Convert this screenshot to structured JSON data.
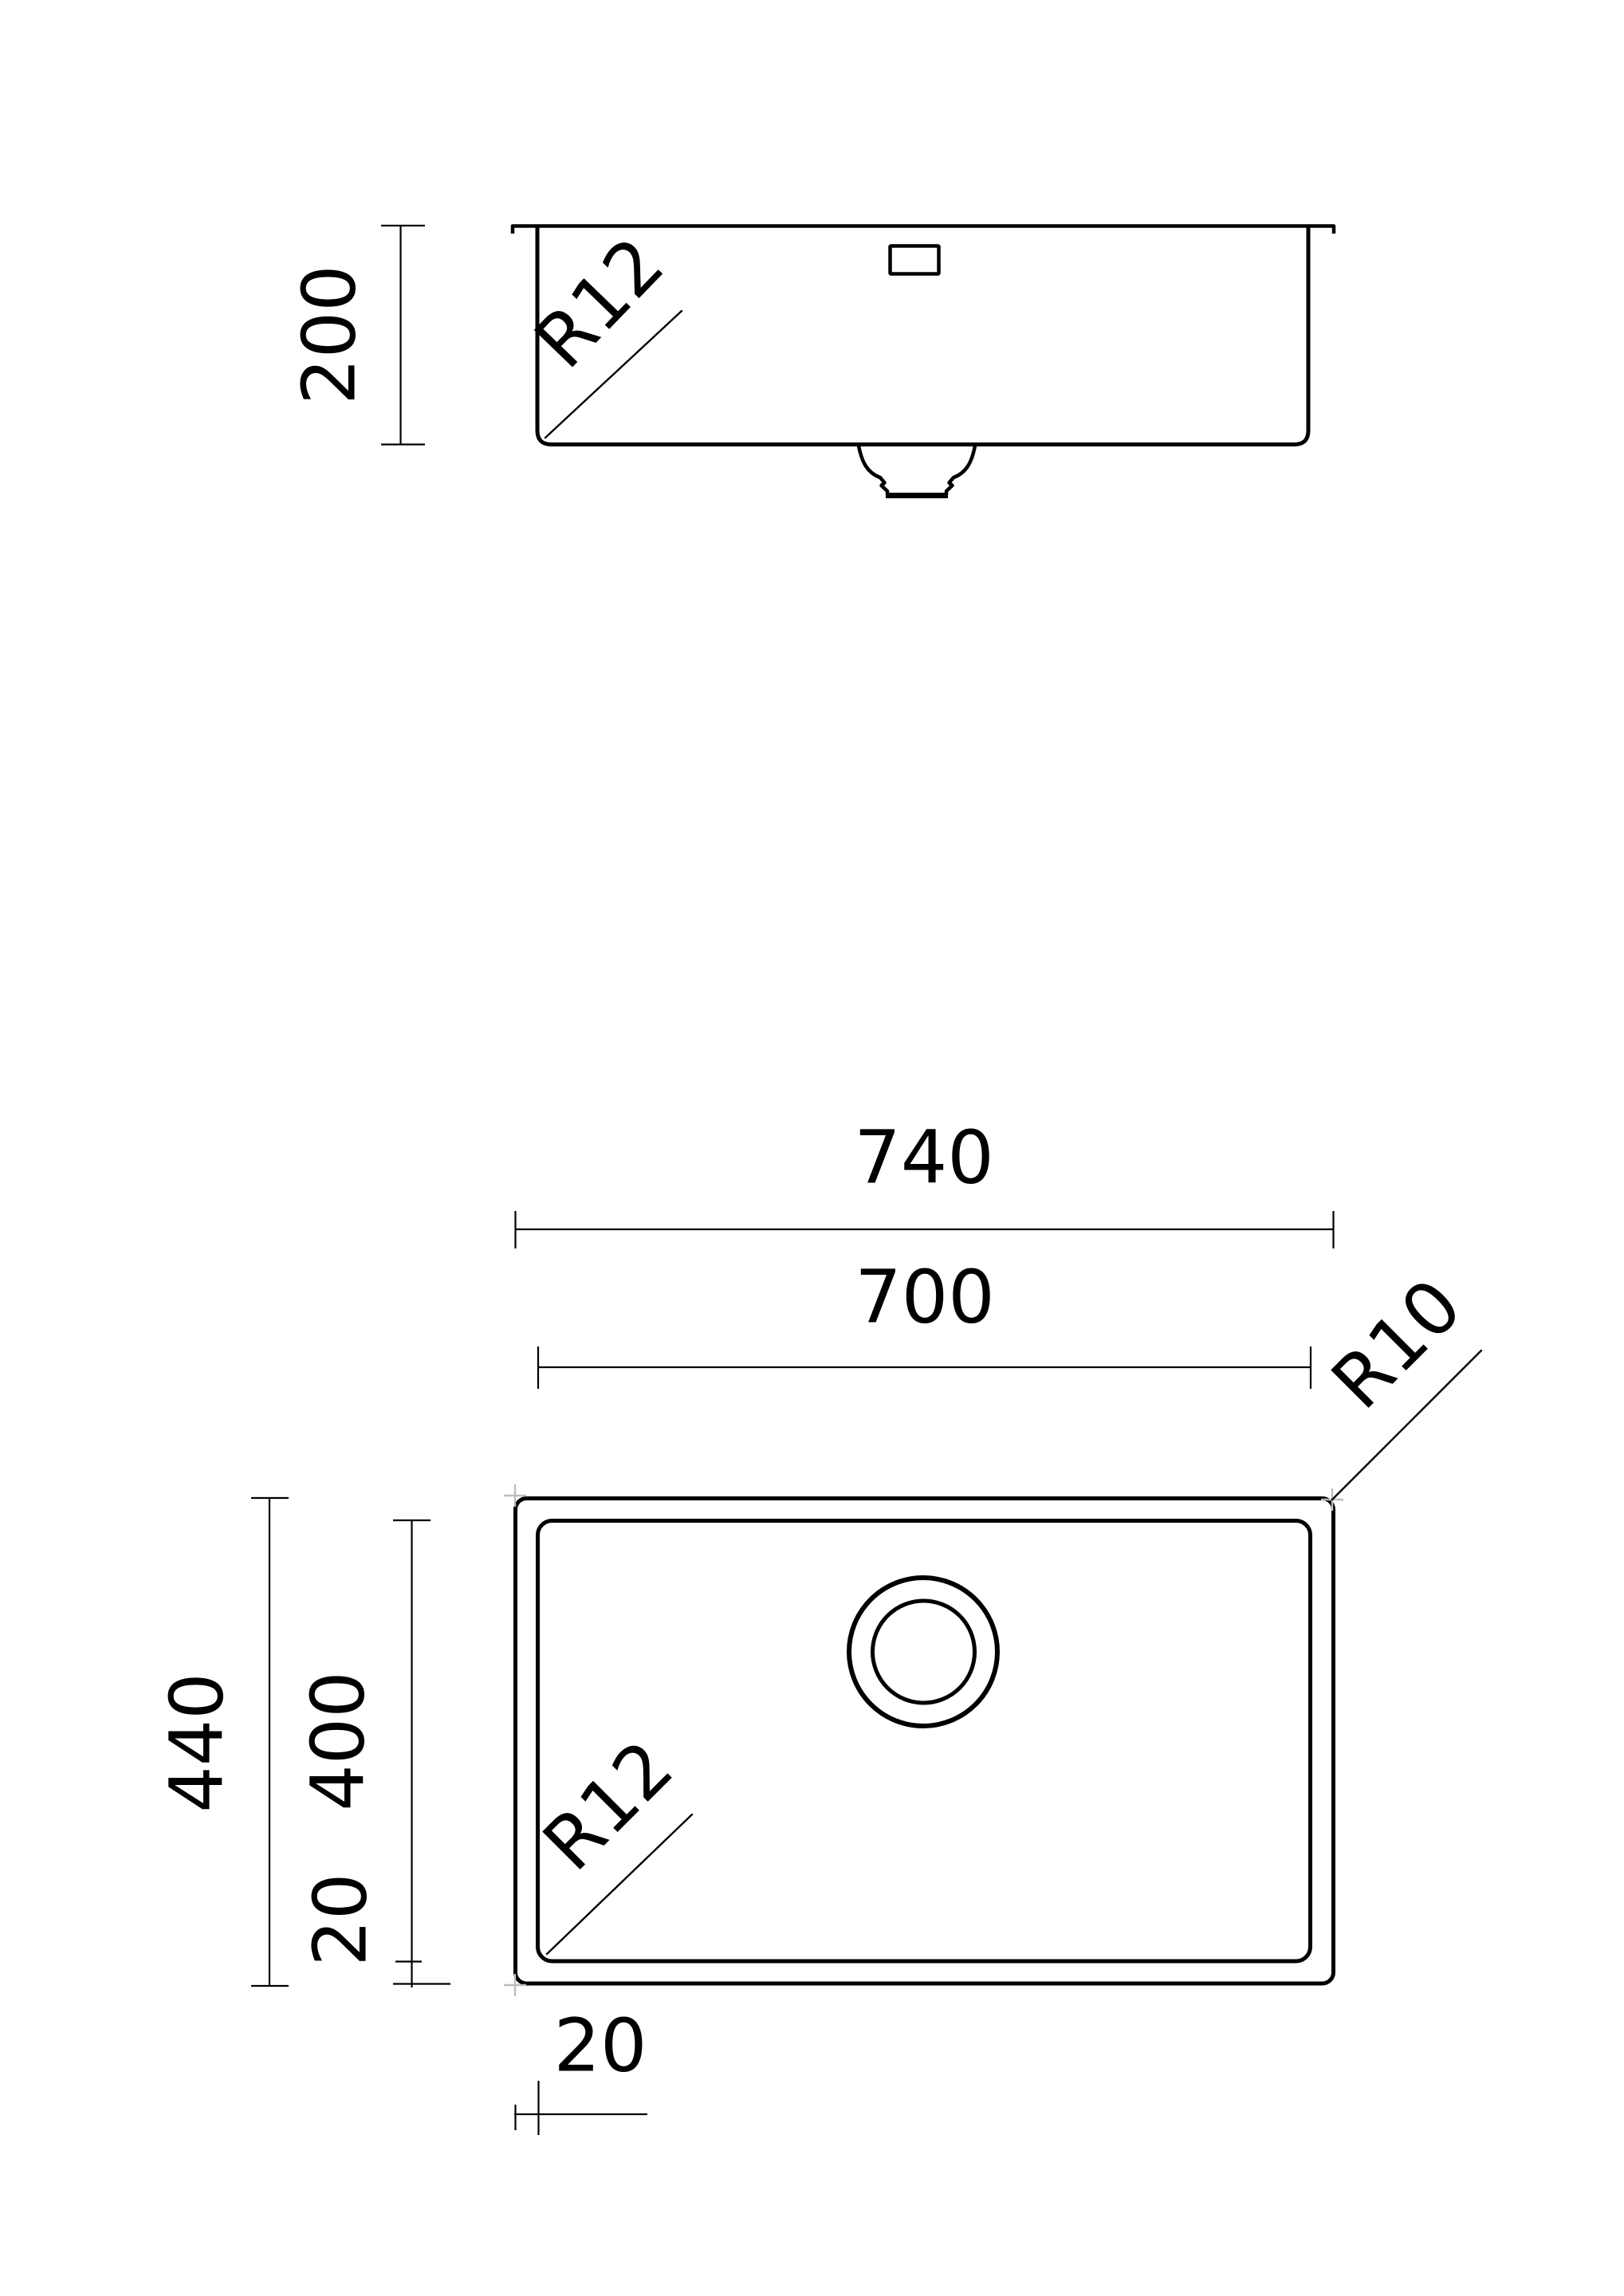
{
  "title": "Undermount sink technical drawing",
  "colors": {
    "background": "#ffffff",
    "line": "#000000",
    "faint_mark": "#bcbcbc"
  },
  "side_view": {
    "depth_label": "200",
    "corner_radius_label": "R12"
  },
  "plan_view": {
    "outer_width_label": "740",
    "inner_width_label": "700",
    "outer_height_label": "440",
    "inner_height_label": "400",
    "left_wall_label": "20",
    "bottom_wall_label": "20",
    "outer_corner_radius_label": "R10",
    "inner_corner_radius_label": "R12"
  }
}
